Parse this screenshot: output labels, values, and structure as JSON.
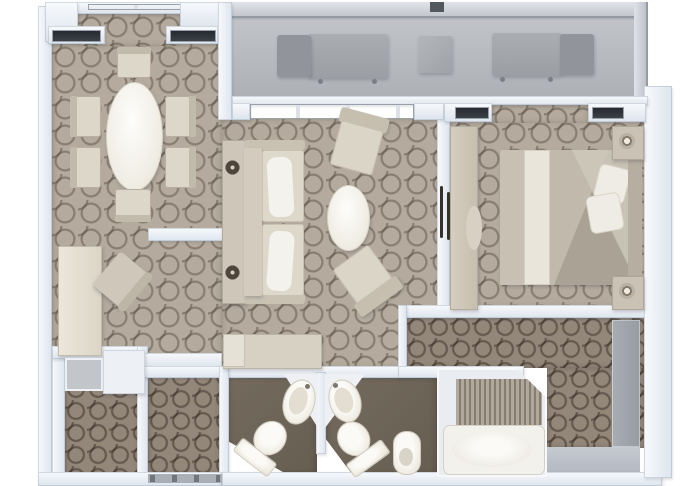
{
  "plan": {
    "name": "suite-floor-plan",
    "view": "top-down-3d-render",
    "rooms": [
      {
        "name": "balcony",
        "floor": "gray-deck",
        "items": [
          {
            "name": "chaise-lounger",
            "count": 2
          },
          {
            "name": "side-table",
            "count": 1
          }
        ]
      },
      {
        "name": "dining-area",
        "floor": "light-trellis-carpet",
        "items": [
          {
            "name": "oval-dining-table",
            "count": 1
          },
          {
            "name": "dining-chair",
            "count": 6
          }
        ]
      },
      {
        "name": "office-nook",
        "floor": "light-trellis-carpet",
        "items": [
          {
            "name": "desk",
            "count": 1
          },
          {
            "name": "desk-chair",
            "count": 1
          }
        ]
      },
      {
        "name": "living-room",
        "floor": "light-trellis-carpet",
        "items": [
          {
            "name": "sofa",
            "count": 1
          },
          {
            "name": "console-table-with-lamps",
            "count": 1
          },
          {
            "name": "armchair",
            "count": 2
          },
          {
            "name": "oval-coffee-table",
            "count": 1
          },
          {
            "name": "tv-cabinet",
            "count": 1
          }
        ]
      },
      {
        "name": "bedroom",
        "floor": "light-trellis-carpet",
        "items": [
          {
            "name": "double-bed",
            "count": 1
          },
          {
            "name": "nightstand-with-lamp",
            "count": 2
          },
          {
            "name": "dresser-counter",
            "count": 1
          },
          {
            "name": "vanity-stool",
            "count": 1
          }
        ]
      },
      {
        "name": "walk-in-closet",
        "floor": "dark-trellis-carpet",
        "items": [
          {
            "name": "shelf-unit",
            "count": 1
          },
          {
            "name": "cabinet",
            "count": 1
          }
        ]
      },
      {
        "name": "entry-hall",
        "floor": "dark-trellis-carpet",
        "items": [
          {
            "name": "entry-door-threshold",
            "count": 1
          }
        ]
      },
      {
        "name": "guest-bathroom",
        "floor": "dark-tile",
        "items": [
          {
            "name": "sink-basin",
            "count": 1
          },
          {
            "name": "toilet",
            "count": 1
          }
        ]
      },
      {
        "name": "master-bathroom",
        "floor": "dark-tile",
        "items": [
          {
            "name": "sink-basin",
            "count": 1
          },
          {
            "name": "toilet",
            "count": 1
          },
          {
            "name": "bidet",
            "count": 1
          },
          {
            "name": "bathtub",
            "count": 1
          },
          {
            "name": "slatted-mat",
            "count": 1
          }
        ]
      },
      {
        "name": "dressing-corridor",
        "floor": "dark-trellis-carpet",
        "items": [
          {
            "name": "closet-sliding-doors",
            "count": 1
          }
        ]
      }
    ],
    "openings": [
      {
        "name": "sliding-glass-door-living"
      },
      {
        "name": "bedroom-bay-windows",
        "count": 2
      },
      {
        "name": "dining-bay-windows",
        "count": 3
      },
      {
        "name": "bedroom-door",
        "handles": 2
      }
    ]
  },
  "palette": {
    "carpet_light": "#b4aa9e",
    "carpet_pattern_line": "#56493e",
    "carpet_dark": "#93877a",
    "bath_floor": "#6f655a",
    "wall_white": "#eef2f7",
    "glass_dark": "#2c3035",
    "furniture_beige": "#d6cfc1",
    "fixture_white": "#f4f2ec",
    "balcony_gray": "#b3b6ba",
    "landing_gray": "#bcc2ca"
  }
}
